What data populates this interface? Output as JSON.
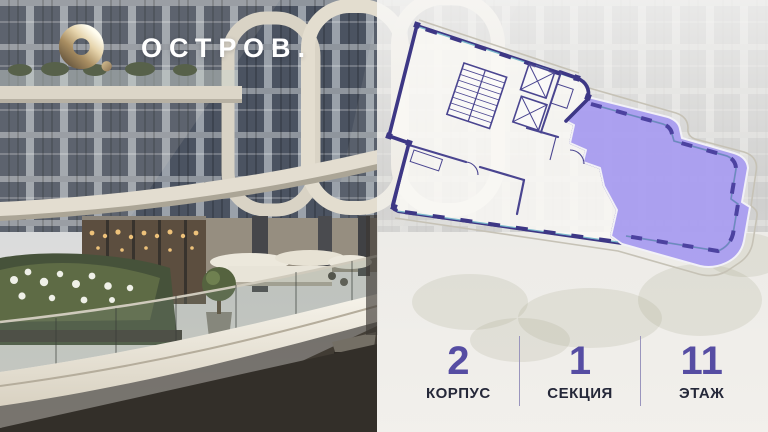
{
  "brand": {
    "logo_mark": "О.",
    "name": "ОСТРОВ.",
    "colors": {
      "gold": "#c9b084",
      "text": "#ffffff"
    }
  },
  "floor_plan": {
    "kind": "apartment-floor-plan",
    "highlighted_unit": {
      "fill": "#a99df0",
      "border": "#4c42a0"
    },
    "wall_color": "#3d3785",
    "window_color": "#78b7ca",
    "balcony_outline_color": "#c6c2b6",
    "core_elements": [
      "stairwell",
      "elevator-shaft",
      "elevator-shaft"
    ]
  },
  "stats": {
    "accent_color": "#564da3",
    "label_color": "#252839",
    "divider_color": "#9a95bd",
    "items": [
      {
        "value": "2",
        "label": "КОРПУС"
      },
      {
        "value": "1",
        "label": "СЕКЦИЯ"
      },
      {
        "value": "11",
        "label": "ЭТАЖ"
      }
    ]
  }
}
